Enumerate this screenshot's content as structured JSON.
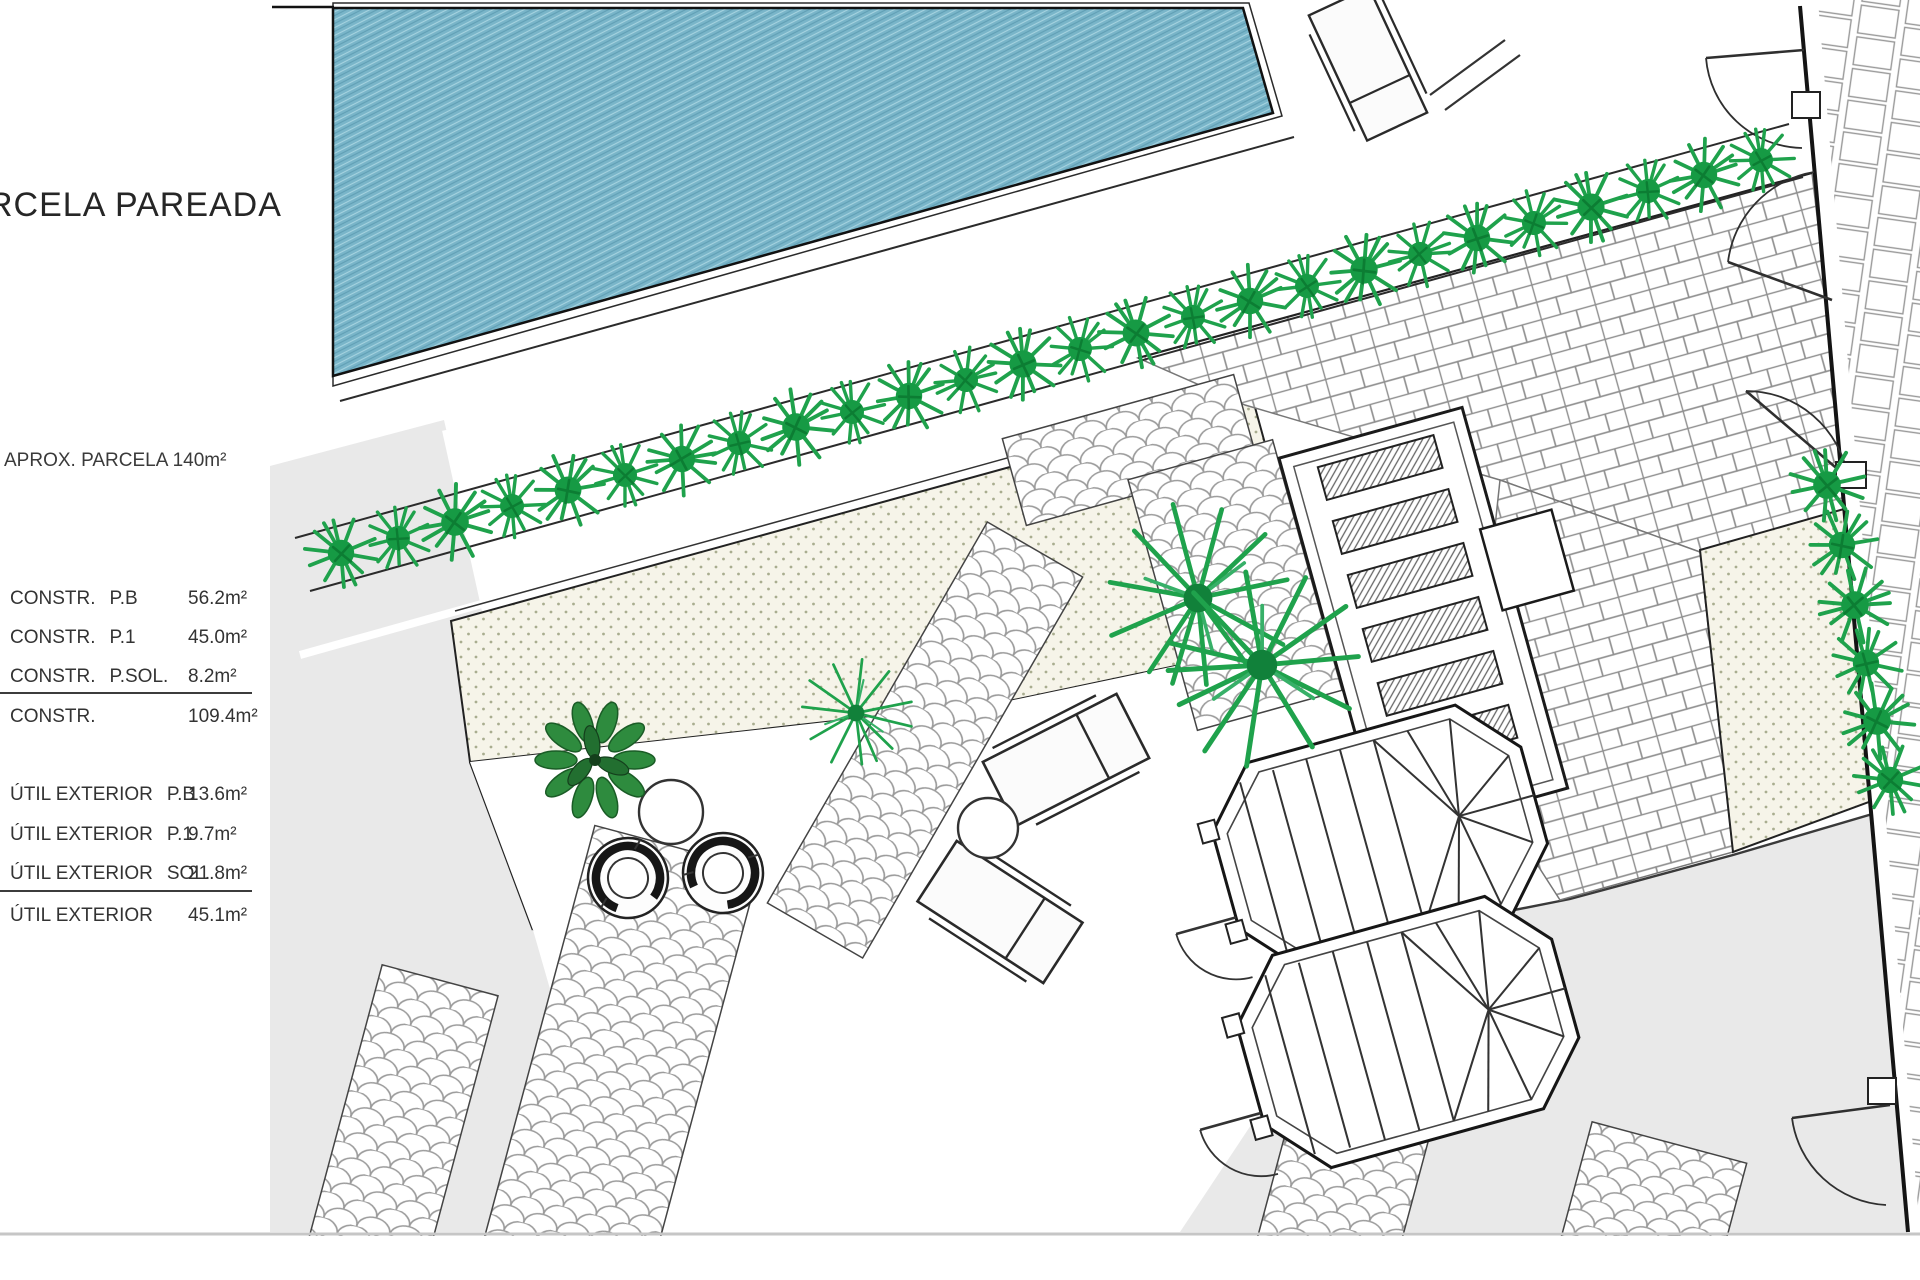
{
  "page": {
    "title": "RCELA PAREADA",
    "parcela_note": "APROX. PARCELA 140m²"
  },
  "areas_table": {
    "constructed": {
      "rows": [
        {
          "label": "CONSTR.",
          "sub": "P.B",
          "value": "56.2m²"
        },
        {
          "label": "CONSTR.",
          "sub": "P.1",
          "value": "45.0m²"
        },
        {
          "label": "CONSTR.",
          "sub": "P.SOL.",
          "value": "8.2m²"
        }
      ],
      "total": {
        "label": "CONSTR.",
        "sub": "",
        "value": "109.4m²"
      }
    },
    "exterior": {
      "rows": [
        {
          "label": "ÚTIL  EXTERIOR",
          "sub": "P.B",
          "value": "13.6m²"
        },
        {
          "label": "ÚTIL  EXTERIOR",
          "sub": "P.1",
          "value": "9.7m²"
        },
        {
          "label": "ÚTIL  EXTERIOR",
          "sub": "SOL.",
          "value": "21.8m²"
        }
      ],
      "total": {
        "label": "ÚTIL  EXTERIOR",
        "sub": "",
        "value": "45.1m²"
      }
    }
  },
  "colors": {
    "pool_water": "#79b5c9",
    "vegetation_green": "#1fa24c",
    "parcel_gray": "#e9e9e9",
    "stipple_ground": "#f6f4e9",
    "wall_black": "#161616",
    "footer_line": "#c6c6c6"
  },
  "plan_features": [
    "swimming-pool",
    "hedge-row",
    "gravel-stipple-band",
    "brick-patio",
    "cobblestone-path",
    "sun-lounger",
    "round-table",
    "ring-chair",
    "leafy-tree",
    "palm-plant",
    "straight-staircase",
    "octagonal-winder-staircase",
    "door-swing",
    "boundary-wall"
  ]
}
